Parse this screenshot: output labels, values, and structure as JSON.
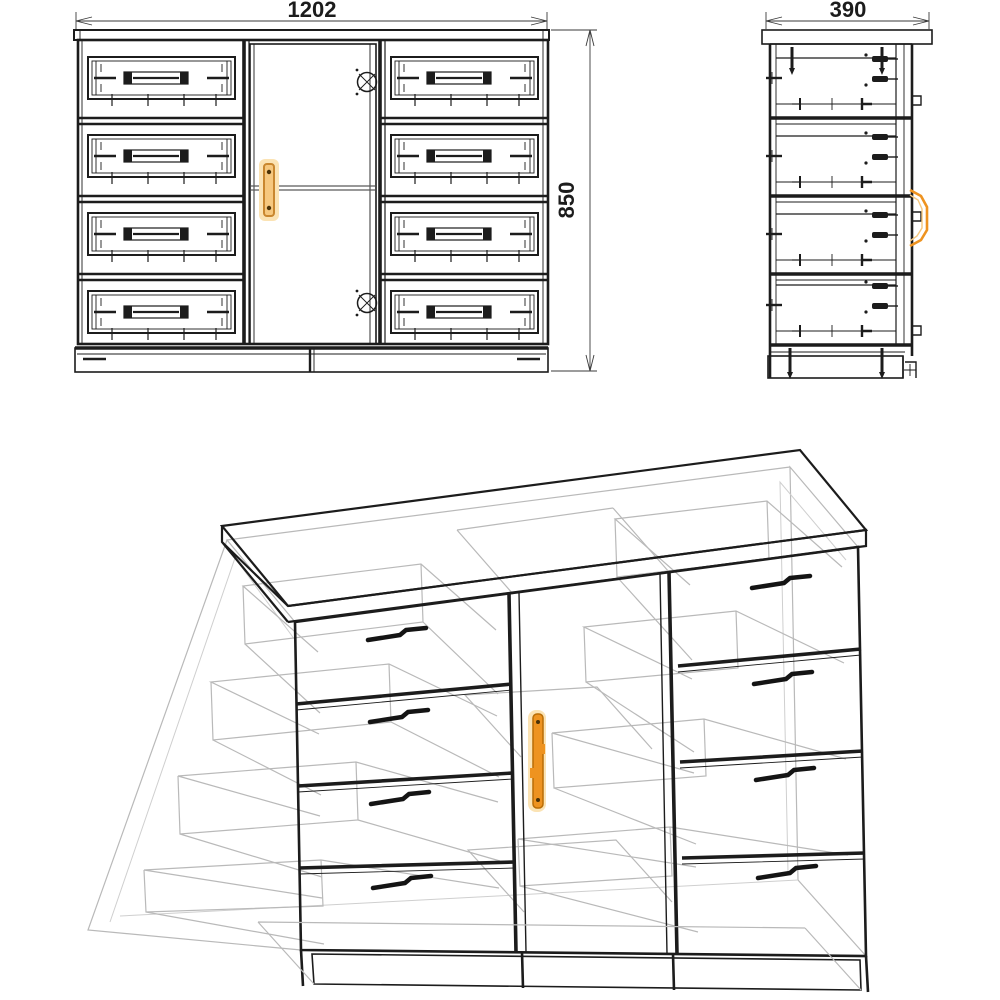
{
  "dimensions": {
    "width": "1202",
    "depth": "390",
    "height": "850"
  },
  "structure": {
    "drawers_left_column": 4,
    "drawers_right_column": 4,
    "doors": 1,
    "hinges_on_door": 2
  },
  "colors": {
    "line": "#1c1c1c",
    "hidden_line": "#b9b9b9",
    "accent_handle": "#ee9320",
    "handle_fill": "#f6c87f",
    "handle_glow": "#fbe3b4",
    "handle_outline": "#c9872f",
    "handle_screw": "#4a3208",
    "text": "#1c1c1c",
    "background": "#ffffff"
  }
}
